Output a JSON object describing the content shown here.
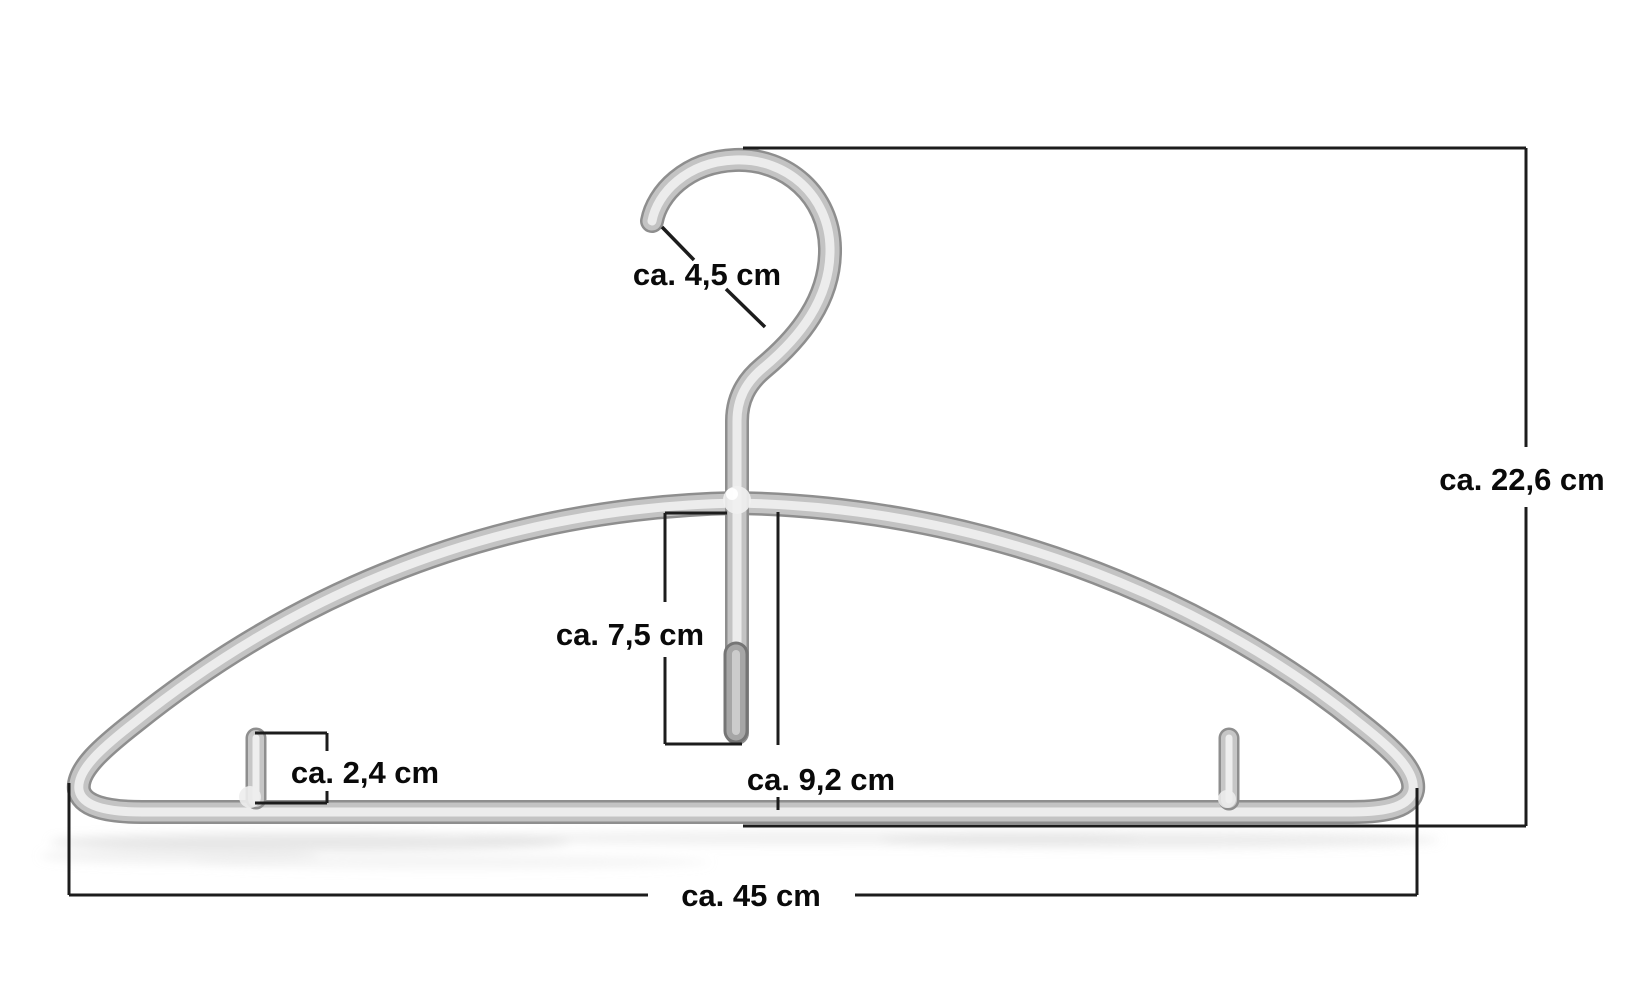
{
  "diagram": {
    "subject": "clothes-hanger-dimension-drawing",
    "measurements": {
      "hook_opening": {
        "label": "ca. 4,5 cm"
      },
      "total_height": {
        "label": "ca. 22,6 cm"
      },
      "stem_drop": {
        "label": "ca. 7,5 cm"
      },
      "peg_height": {
        "label": "ca. 2,4 cm"
      },
      "center_drop": {
        "label": "ca. 9,2 cm"
      },
      "total_width": {
        "label": "ca. 45 cm"
      }
    },
    "colors": {
      "background": "#ffffff",
      "dimension_line": "#1c1c1c",
      "label_text": "#0a0a0a",
      "metal_edge": "#8e8e8e",
      "metal_mid": "#c3c3c3",
      "metal_highlight": "#ececec"
    }
  }
}
